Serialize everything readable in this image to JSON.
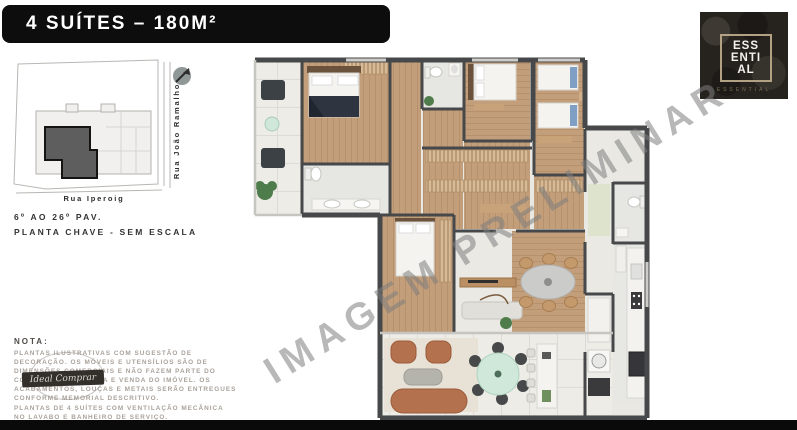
{
  "page": {
    "background": "#ffffff",
    "footer_bar_color": "#0a0a0a"
  },
  "header": {
    "title": "4 SUÍTES – 180M²"
  },
  "brand": {
    "name_lines": [
      "ESS",
      "ENTI",
      "AL"
    ],
    "subtitle": "ESSENTIAL",
    "frame_color": "#b3a184"
  },
  "key_plan": {
    "street_right": "Rua João Ramalho",
    "street_bottom": "Rua Iperoig",
    "floors_label": "6º AO 26º PAV.",
    "scale_label": "PLANTA CHAVE - SEM ESCALA",
    "highlight_color": "#5e5e5e"
  },
  "note": {
    "heading": "NOTA:",
    "paragraph1": [
      "PLANTAS ILUSTRATIVAS COM SUGESTÃO DE",
      "DECORAÇÃO. OS MÓVEIS E UTENSÍLIOS SÃO DE",
      "DIMENSÕES COMERCIAIS E NÃO FAZEM PARTE DO",
      "CONTRATO DE COMPRA E VENDA DO IMÓVEL. OS",
      "ACABAMENTOS, LOUÇAS E METAIS SERÃO ENTREGUES",
      "CONFORME MEMORIAL DESCRITIVO."
    ],
    "paragraph2": [
      "PLANTAS DE 4 SUÍTES COM VENTILAÇÃO MECÂNICA",
      "NO LAVABO E BANHEIRO DE SERVIÇO."
    ],
    "stamp_text": "Ideal Comprar"
  },
  "watermark": {
    "text": "IMAGEM PRELIMINAR",
    "color": "#8f8f8f"
  },
  "floor_plan": {
    "colors": {
      "wall": "#46484a",
      "wood": "#c39e7b",
      "bath": "#e6e6e2",
      "terrace": "#edece7",
      "accent_rust": "#b4714e",
      "accent_mint": "#cfe8da",
      "accent_blue": "#7f9fc4",
      "plant": "#4e7c4a"
    }
  }
}
